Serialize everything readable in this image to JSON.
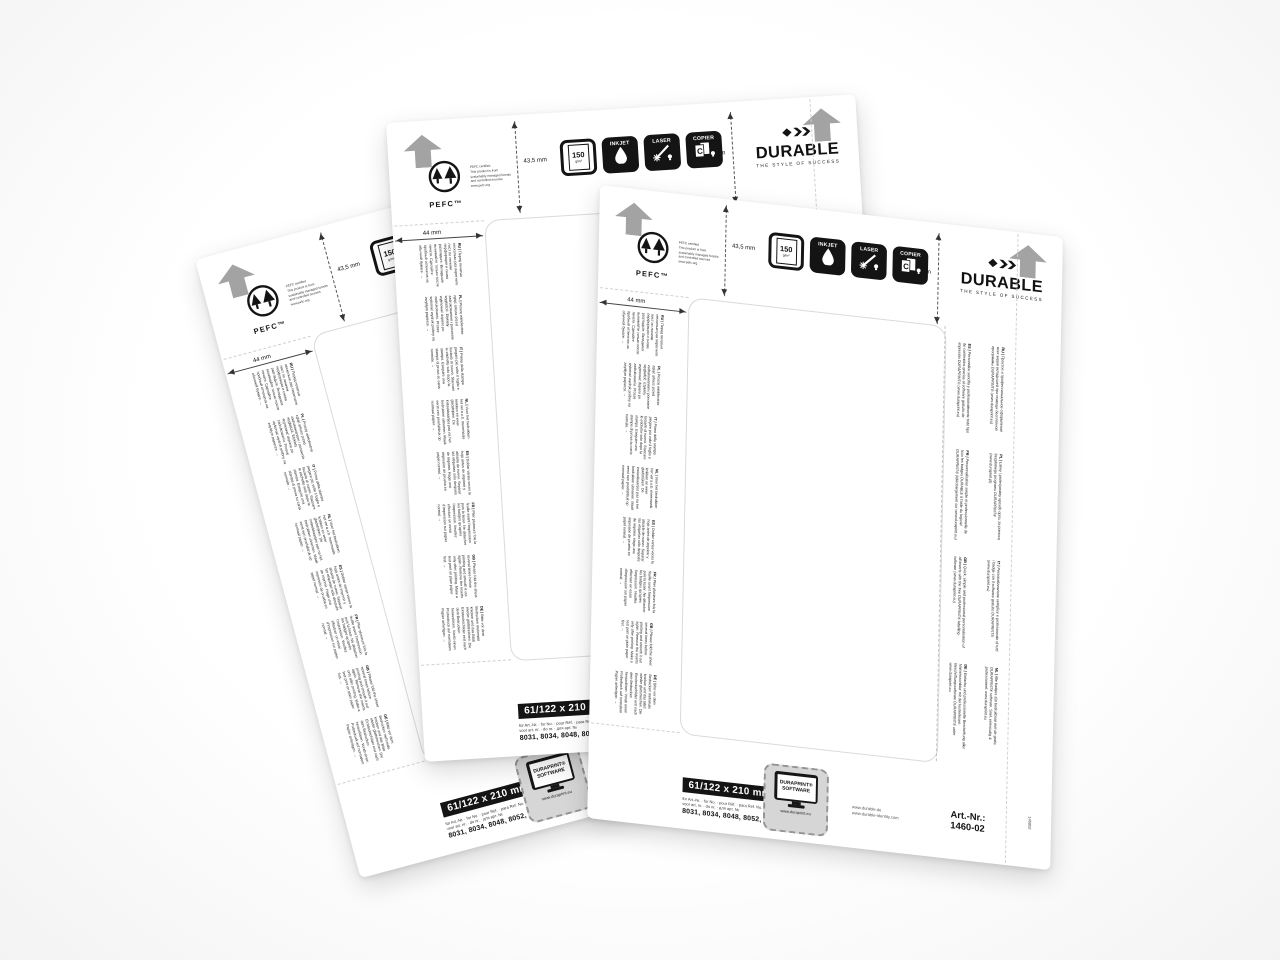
{
  "branding": {
    "durable": {
      "wordmark": "DURABLE",
      "tagline": "THE STYLE OF SUCCESS"
    },
    "pefc": {
      "wordmark": "PEFC™",
      "caption_lines": [
        "PEFC certified",
        "This product is from",
        "sustainably managed forests",
        "and controlled sources",
        "www.pefc.org"
      ]
    }
  },
  "pictograms": {
    "paper": {
      "value": "150",
      "unit": "g/m²"
    },
    "inkjet": "INKJET",
    "laser": "LASER",
    "copier": "COPIER"
  },
  "dimensions": {
    "vertical": "43,5 mm",
    "horizontal": "44 mm"
  },
  "size_badge": "61/122 x 210 mm",
  "article_reference": {
    "for_lines": [
      "für Art.-Nr. · for No. · pour Réf. · para Ref. No.",
      "voor art. nr. · do nr. · для арт. №"
    ],
    "numbers": "8031, 8034, 8048, 8052, 8202, 8271"
  },
  "duraprint": {
    "line1": "DURAPRINT®",
    "line2": "SOFTWARE",
    "url": "www.duraprint.eu"
  },
  "footer": {
    "websites": [
      "www.durable.de",
      "www.durable-identity.com"
    ],
    "artnr_label": "Art.-Nr.:",
    "artnr_value": "1460-02",
    "edge_code": "146002"
  },
  "instructions_fold": [
    {
      "label": "RU |",
      "text": "Перед печатью несколько раз перегните лист по линиям перфорации и снова разгладьте. Вкладыши вынимайте только после печати. Сделайте пробный отпечаток на обычной бумаге. →"
    },
    {
      "label": "PL |",
      "text": "Proszę wielokrotnie zgiąć arkusz przed zadrukowaniem i ponownie wygładzić. Etykiety wyjmować dopiero po zadrukowaniu. Proszę wykonać wydruk próbny na zwykłym papierze. →"
    },
    {
      "label": "IT |",
      "text": "Prima della stampa piegare più volte il foglio e lisciarlo di nuovo. Staccare le etichette solo dopo la stampa. Eseguire una stampa di prova su carta normale. →"
    },
    {
      "label": "NL |",
      "text": "Voor het bedrukken het vel a.u.b. meermaals knikken en weer gladstrijken. De insteekkaartjes pas na het bedrukken uitnemen. Maak eerst een proefafdruk op normaal papier. →"
    },
    {
      "label": "ES |",
      "text": "Doblar varias veces la hoja antes de imprimir y alisarla de nuevo. Separar las etiquetas sólo después de imprimir. Haga una impresión de prueba en papel normal. →"
    },
    {
      "label": "FR |",
      "text": "Plier plusieurs fois la feuille avant l'impression puis la lisser. Ne détacher les badges qu'après l'impression. Veuillez effectuer un essai d'impression sur papier normal. →"
    },
    {
      "label": "GB |",
      "text": "Please fold the sheet several times before printing and smooth it out again. Remove the inserts only after printing. Make a test print on plain paper first. →"
    },
    {
      "label": "DE |",
      "text": "Bitte vor dem Bedrucken mehrmals knicken und das Blatt wieder glattstreichen. Die Einsteckschilder erst nach dem Bedrucken herauslösen. Vorab einen Probedruck auf normalem Papier anfertigen. →"
    }
  ],
  "instructions_software": [
    [
      {
        "label": "ES |",
        "text": "Personalice sencilla y profesionalmente todo tipo de contenidos gracias al software gratuito de impresión DURAPRINT® (www.duraprint.eu)"
      },
      {
        "label": "RU |",
        "text": "Простое и профессиональное оформление всех видов вкладышей при помощи бесплатной программы DURAPRINT® (www.duraprint.eu)"
      }
    ],
    [
      {
        "label": "FR |",
        "text": "Personnalisation simple et professionnelle de tous les badges DURABLE à l'aide du logiciel DURAPRINT® (téléchargement sur www.duraprint.eu)"
      },
      {
        "label": "PL |",
        "text": "Łatwy i profesjonalny sposób opisu za pomocą bezpłatnego programu DURAPRINT® (www.duraprint.pl)"
      }
    ],
    [
      {
        "label": "GB |",
        "text": "Quick, simple and professional personalisation of all inserts with the free DURAPRINT® labelling software (www.duraprint.eu)"
      },
      {
        "label": "IT |",
        "text": "Personalizzazione semplice e professionale di tutti i badge con il software gratuito DURAPRINT® (www.duraprint.eu)"
      }
    ],
    [
      {
        "label": "DE |",
        "text": "Einfache und professionelle Beschriftung aller Namensschilder mit der kostenlosen Beschriftungssoftware DURAPRINT® unter www.duraprint.eu"
      },
      {
        "label": "NL |",
        "text": "Alle badges zijn bedrukbaar met de gratis DURAPRINT® software. Snel, eenvoudig & professioneel: www.duraprint.eu"
      }
    ]
  ]
}
